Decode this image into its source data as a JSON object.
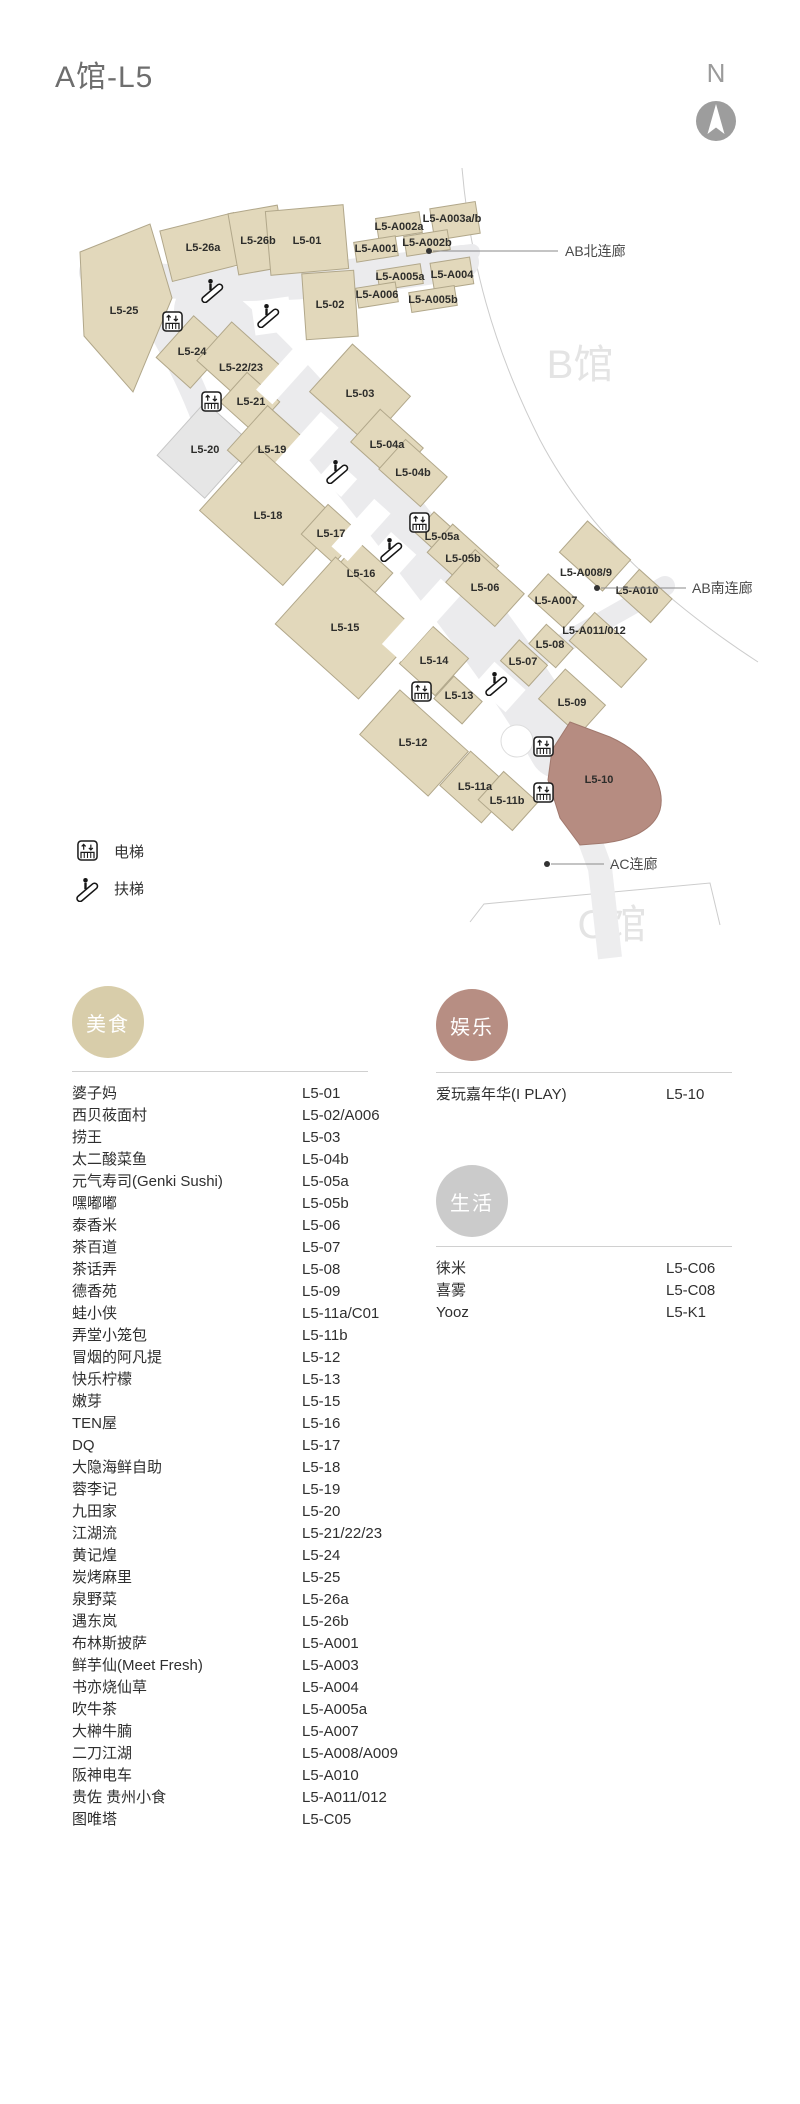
{
  "header": {
    "title": "A馆-L5",
    "compass": "N"
  },
  "map": {
    "units": [
      "L5-26a",
      "L5-26b",
      "L5-01",
      "L5-A002a",
      "L5-A003a/b",
      "L5-A001",
      "L5-A002b",
      "L5-A005a",
      "L5-A004",
      "L5-A006",
      "L5-A005b",
      "L5-25",
      "L5-02",
      "L5-24",
      "L5-22/23",
      "L5-21",
      "L5-20",
      "L5-19",
      "L5-03",
      "L5-18",
      "L5-17",
      "L5-04a",
      "L5-04b",
      "L5-05a",
      "L5-05b",
      "L5-16",
      "L5-06",
      "L5-15",
      "L5-14",
      "L5-13",
      "L5-A008/9",
      "L5-A010",
      "L5-A007",
      "L5-A011/012",
      "L5-08",
      "L5-07",
      "L5-12",
      "L5-09",
      "L5-11a",
      "L5-11b",
      "L5-10"
    ],
    "links": {
      "north": "AB北连廊",
      "south": "AB南连廊",
      "ac": "AC连廊"
    },
    "buildings": {
      "b": "B馆",
      "c": "C馆"
    },
    "highlight_unit": "L5-10",
    "colors": {
      "store": "#e2d8bb",
      "store_border": "#b1a78a",
      "corridor": "#ebebed",
      "vacant": "#e6e6e6",
      "vacant_border": "#c6c6c6",
      "highlight": "#b68c81",
      "highlight_border": "#a0786d"
    }
  },
  "legend": {
    "elevator": "电梯",
    "escalator": "扶梯"
  },
  "directory": {
    "food": {
      "category": "美食",
      "color": "#d8cdaa",
      "items": [
        {
          "name": "婆子妈",
          "unit": "L5-01"
        },
        {
          "name": "西贝莜面村",
          "unit": "L5-02/A006"
        },
        {
          "name": "捞王",
          "unit": "L5-03"
        },
        {
          "name": "太二酸菜鱼",
          "unit": "L5-04b"
        },
        {
          "name": "元气寿司(Genki Sushi)",
          "unit": "L5-05a"
        },
        {
          "name": "嘿嘟嘟",
          "unit": "L5-05b"
        },
        {
          "name": "泰香米",
          "unit": "L5-06"
        },
        {
          "name": "茶百道",
          "unit": "L5-07"
        },
        {
          "name": "茶话弄",
          "unit": "L5-08"
        },
        {
          "name": "德香苑",
          "unit": "L5-09"
        },
        {
          "name": "蛙小侠",
          "unit": "L5-11a/C01"
        },
        {
          "name": "弄堂小笼包",
          "unit": "L5-11b"
        },
        {
          "name": "冒烟的阿凡提",
          "unit": "L5-12"
        },
        {
          "name": "快乐柠檬",
          "unit": "L5-13"
        },
        {
          "name": "嫩芽",
          "unit": "L5-15"
        },
        {
          "name": "TEN屋",
          "unit": "L5-16"
        },
        {
          "name": "DQ",
          "unit": "L5-17"
        },
        {
          "name": "大隐海鲜自助",
          "unit": "L5-18"
        },
        {
          "name": "蓉李记",
          "unit": "L5-19"
        },
        {
          "name": "九田家",
          "unit": "L5-20"
        },
        {
          "name": "江湖流",
          "unit": "L5-21/22/23"
        },
        {
          "name": "黄记煌",
          "unit": "L5-24"
        },
        {
          "name": "炭烤麻里",
          "unit": "L5-25"
        },
        {
          "name": "泉野菜",
          "unit": "L5-26a"
        },
        {
          "name": "遇东岚",
          "unit": "L5-26b"
        },
        {
          "name": "布林斯披萨",
          "unit": "L5-A001"
        },
        {
          "name": "鲜芋仙(Meet Fresh)",
          "unit": "L5-A003"
        },
        {
          "name": "书亦烧仙草",
          "unit": "L5-A004"
        },
        {
          "name": "吹牛茶",
          "unit": "L5-A005a"
        },
        {
          "name": "大榊牛腩",
          "unit": "L5-A007"
        },
        {
          "name": "二刀江湖",
          "unit": "L5-A008/A009"
        },
        {
          "name": "阪神电车",
          "unit": "L5-A010"
        },
        {
          "name": "贵佐 贵州小食",
          "unit": "L5-A011/012"
        },
        {
          "name": "图唯塔",
          "unit": "L5-C05"
        }
      ]
    },
    "entertainment": {
      "category": "娱乐",
      "color": "#b78e83",
      "items": [
        {
          "name": "爱玩嘉年华(I PLAY)",
          "unit": "L5-10"
        }
      ]
    },
    "life": {
      "category": "生活",
      "color": "#cbcbcb",
      "items": [
        {
          "name": "徕米",
          "unit": "L5-C06"
        },
        {
          "name": "喜雾",
          "unit": "L5-C08"
        },
        {
          "name": "Yooz",
          "unit": "L5-K1"
        }
      ]
    }
  }
}
